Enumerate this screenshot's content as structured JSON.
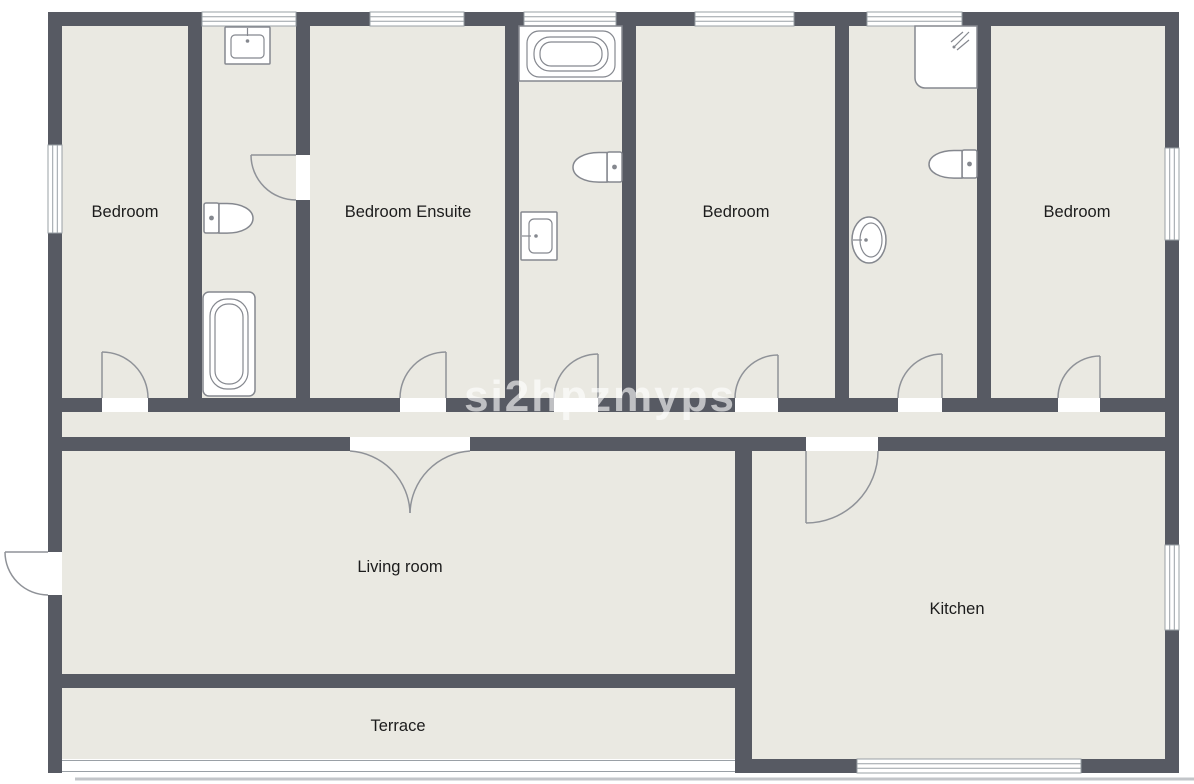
{
  "floorplan": {
    "watermark": "si2hpzmyps",
    "rooms": {
      "bedroom_1": {
        "label": "Bedroom"
      },
      "bedroom_ensuite": {
        "label": "Bedroom Ensuite"
      },
      "bedroom_2": {
        "label": "Bedroom"
      },
      "bedroom_3": {
        "label": "Bedroom"
      },
      "living_room": {
        "label": "Living room"
      },
      "kitchen": {
        "label": "Kitchen"
      },
      "terrace": {
        "label": "Terrace"
      }
    },
    "fixture_icons": [
      "sink-icon",
      "toilet-icon",
      "bathtub-icon",
      "shower-icon",
      "door-arc-icon",
      "window-icon"
    ],
    "colors": {
      "wall": "#575a63",
      "floor": "#eae9e2",
      "fixture_stroke": "#85888f",
      "label_text": "#1c1c1c",
      "watermark": "#ffffff"
    }
  }
}
